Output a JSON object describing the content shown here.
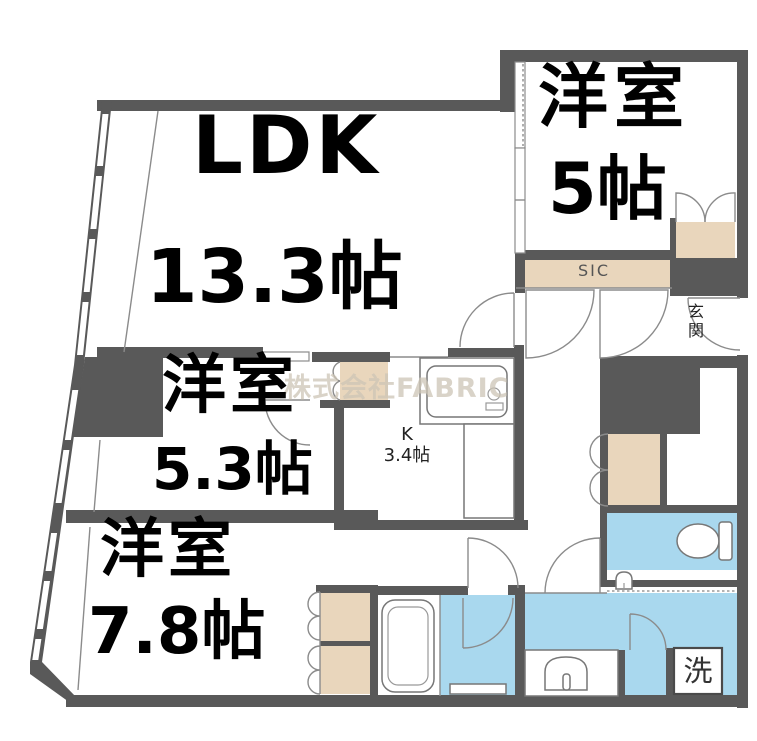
{
  "rooms": {
    "ldk": {
      "name": "LDK",
      "size": "13.3帖"
    },
    "bedroom_top": {
      "name": "洋室",
      "size": "5帖"
    },
    "bedroom_middle": {
      "name": "洋室",
      "size": "5.3帖"
    },
    "bedroom_bottom": {
      "name": "洋室",
      "size": "7.8帖"
    },
    "kitchen": {
      "name": "K",
      "size": "3.4帖"
    }
  },
  "areas": {
    "shoe_closet": "SIC",
    "entrance": "玄関",
    "laundry": "洗"
  },
  "watermark": "株式会社FABRIC",
  "colors": {
    "wall": "#595959",
    "closet_fill": "#e9d6bc",
    "wet_area_fill": "#a9d8ee",
    "line": "#8b8b8b",
    "watermark": "#cdc5b6"
  },
  "fixtures": [
    "kitchen-sink-icon",
    "toilet-icon",
    "bathtub-icon",
    "washbasin-icon",
    "hand-sink-icon",
    "washing-machine-slot"
  ]
}
